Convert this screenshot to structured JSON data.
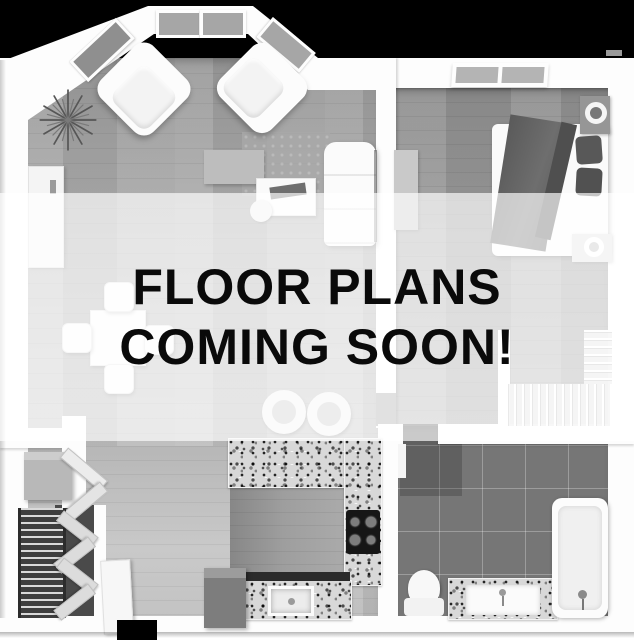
{
  "overlay": {
    "line1": "FLOOR PLANS",
    "line2": "COMING SOON!"
  },
  "colors": {
    "background_top": "#000000",
    "overlay_band": "rgba(255,255,255,0.67)",
    "overlay_text": "#0a0a0a",
    "wall": "#fdfdfd",
    "living_floor": "#b6b6b6",
    "bedroom_floor": "#9f9f9f",
    "bathroom_tile": "#767676",
    "granite_counter": "#d8d8d8",
    "closet_shelf": "#3e3e3e"
  }
}
